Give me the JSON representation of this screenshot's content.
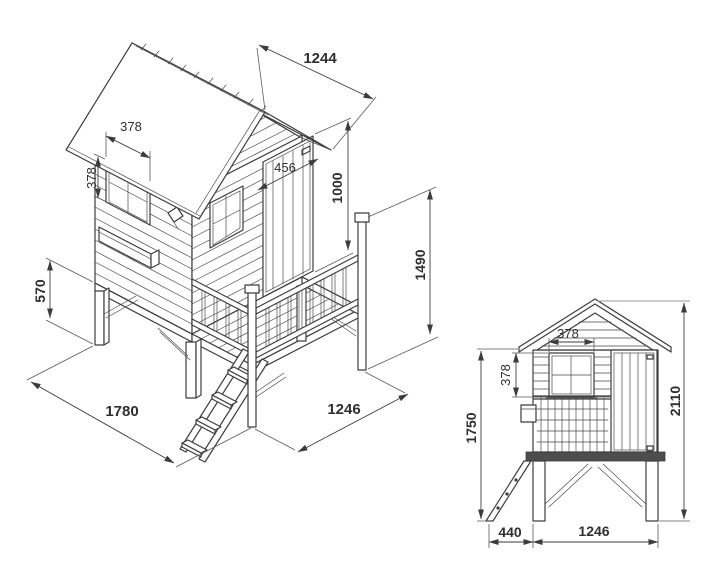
{
  "drawing": {
    "type": "technical-dimension-drawing",
    "subject": "wooden stilted playhouse with porch and ladder",
    "background_color": "#ffffff",
    "line_color": "#3d3d3d",
    "dim_text_color": "#2f2f2f",
    "views": {
      "isometric": {
        "label": "isometric view",
        "dims": {
          "roof_panel_width": "1244",
          "side_window_width": "378",
          "side_window_height": "378",
          "door_width": "456",
          "door_height": "1000",
          "rail_post_height": "1490",
          "leg_height": "570",
          "base_depth": "1780",
          "base_width": "1246"
        }
      },
      "front_elevation": {
        "label": "front elevation view",
        "dims": {
          "window_width": "378",
          "window_height": "378",
          "eaves_height": "1750",
          "overall_height": "2110",
          "ladder_depth": "440",
          "house_width": "1246"
        }
      }
    }
  }
}
